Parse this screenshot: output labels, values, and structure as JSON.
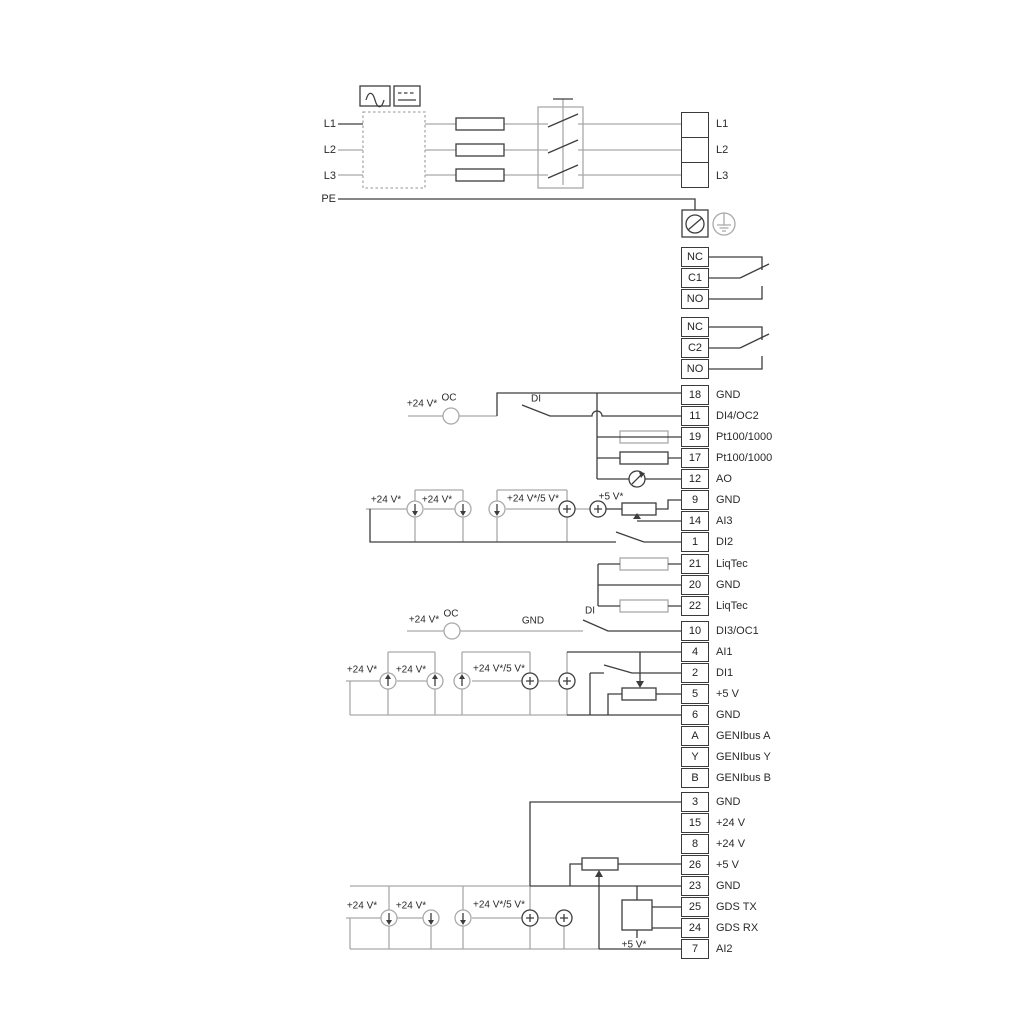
{
  "diagram": {
    "power": {
      "input_labels": [
        "L1",
        "L2",
        "L3"
      ],
      "pe_label": "PE",
      "output_labels": [
        "L1",
        "L2",
        "L3"
      ]
    },
    "labels": {
      "plus24": "+24 V*",
      "plus24_5": "+24 V*/5 V*",
      "plus5": "+5 V*",
      "oc": "OC",
      "di": "DI",
      "gnd": "GND"
    },
    "relays": [
      {
        "terminals": [
          "NC",
          "C1",
          "NO"
        ]
      },
      {
        "terminals": [
          "NC",
          "C2",
          "NO"
        ]
      }
    ],
    "terminal_groups": {
      "io_top": [
        {
          "no": "18",
          "label": "GND"
        },
        {
          "no": "11",
          "label": "DI4/OC2"
        },
        {
          "no": "19",
          "label": "Pt100/1000"
        },
        {
          "no": "17",
          "label": "Pt100/1000"
        },
        {
          "no": "12",
          "label": "AO"
        },
        {
          "no": "9",
          "label": "GND"
        },
        {
          "no": "14",
          "label": "AI3"
        },
        {
          "no": "1",
          "label": "DI2"
        }
      ],
      "liqtec": [
        {
          "no": "21",
          "label": "LiqTec"
        },
        {
          "no": "20",
          "label": "GND"
        },
        {
          "no": "22",
          "label": "LiqTec"
        }
      ],
      "io_mid": [
        {
          "no": "10",
          "label": "DI3/OC1"
        },
        {
          "no": "4",
          "label": "AI1"
        },
        {
          "no": "2",
          "label": "DI1"
        },
        {
          "no": "5",
          "label": "+5 V"
        },
        {
          "no": "6",
          "label": "GND"
        },
        {
          "no": "A",
          "label": "GENIbus A"
        },
        {
          "no": "Y",
          "label": "GENIbus Y"
        },
        {
          "no": "B",
          "label": "GENIbus B"
        }
      ],
      "io_bottom": [
        {
          "no": "3",
          "label": "GND"
        },
        {
          "no": "15",
          "label": "+24 V"
        },
        {
          "no": "8",
          "label": "+24 V"
        },
        {
          "no": "26",
          "label": "+5 V"
        },
        {
          "no": "23",
          "label": "GND"
        },
        {
          "no": "25",
          "label": "GDS TX"
        },
        {
          "no": "24",
          "label": "GDS RX"
        },
        {
          "no": "7",
          "label": "AI2"
        }
      ]
    },
    "colors": {
      "line_dark": "#3d3d3d",
      "line_gray": "#a9a9a9",
      "text": "#2a2a2a"
    }
  }
}
